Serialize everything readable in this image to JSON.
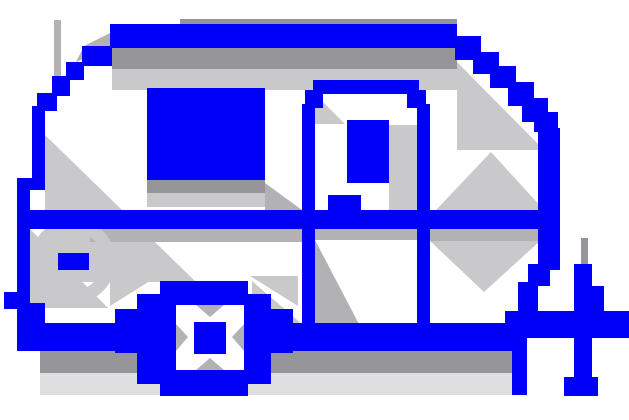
{
  "canvas": {
    "width": 629,
    "height": 420,
    "background": "#ffffff"
  },
  "icon": {
    "name": "camper-trailer-pixel-icon",
    "palette": {
      "blue": "#0000f8",
      "white": "#ffffff",
      "grayDark": "#96969a",
      "grayMid": "#b2b2b4",
      "grayLight": "#c9c9cb",
      "grayPale": "#dfdfe1"
    },
    "shapes": [
      {
        "name": "shadow-roof-topline",
        "type": "rect",
        "x": 180,
        "y": 19,
        "w": 277,
        "h": 6,
        "fill": "grayDark"
      },
      {
        "name": "shadow-under-roof-dark",
        "type": "rect",
        "x": 112,
        "y": 48,
        "w": 345,
        "h": 21,
        "fill": "grayDark"
      },
      {
        "name": "shadow-under-roof-light",
        "type": "rect",
        "x": 112,
        "y": 69,
        "w": 345,
        "h": 21,
        "fill": "grayLight"
      },
      {
        "name": "shadow-front-line",
        "type": "rect",
        "x": 54,
        "y": 20,
        "w": 7,
        "h": 74,
        "fill": "grayMid"
      },
      {
        "name": "shadow-front-wedge",
        "type": "polygon",
        "points": [
          [
            110,
            33
          ],
          [
            110,
            48
          ],
          [
            76,
            62
          ],
          [
            84,
            46
          ]
        ],
        "fill": "grayMid"
      },
      {
        "name": "shadow-left-interior",
        "type": "polygon",
        "points": [
          [
            45,
            135
          ],
          [
            196,
            282
          ],
          [
            45,
            282
          ]
        ],
        "fill": "grayLight"
      },
      {
        "name": "shadow-right-interior",
        "type": "polygon",
        "points": [
          [
            457,
            62
          ],
          [
            544,
            150
          ],
          [
            457,
            150
          ]
        ],
        "fill": "grayLight"
      },
      {
        "name": "shadow-window-sill-dark",
        "type": "rect",
        "x": 147,
        "y": 180,
        "w": 118,
        "h": 13,
        "fill": "grayDark"
      },
      {
        "name": "shadow-window-sill-light",
        "type": "rect",
        "x": 147,
        "y": 193,
        "w": 118,
        "h": 14,
        "fill": "grayLight"
      },
      {
        "name": "shadow-window-door-wedge",
        "type": "polygon",
        "points": [
          [
            265,
            183
          ],
          [
            302,
            210
          ],
          [
            265,
            210
          ]
        ],
        "fill": "grayMid"
      },
      {
        "name": "shadow-door-jamb",
        "type": "rect",
        "x": 389,
        "y": 125,
        "w": 28,
        "h": 104,
        "fill": "grayLight"
      },
      {
        "name": "shadow-door-top-wedge",
        "type": "polygon",
        "points": [
          [
            315,
            94
          ],
          [
            345,
            124
          ],
          [
            315,
            124
          ]
        ],
        "fill": "grayLight"
      },
      {
        "name": "shadow-under-rail-left",
        "type": "rect",
        "x": 90,
        "y": 229,
        "w": 212,
        "h": 13,
        "fill": "grayMid"
      },
      {
        "name": "shadow-under-rail-right",
        "type": "rect",
        "x": 430,
        "y": 229,
        "w": 108,
        "h": 12,
        "fill": "grayMid"
      },
      {
        "name": "shadow-under-rail-door",
        "type": "rect",
        "x": 315,
        "y": 229,
        "w": 102,
        "h": 11,
        "fill": "grayMid"
      },
      {
        "name": "shadow-door-lower-wedge",
        "type": "polygon",
        "points": [
          [
            315,
            240
          ],
          [
            360,
            326
          ],
          [
            315,
            326
          ]
        ],
        "fill": "grayMid"
      },
      {
        "name": "shadow-rail-x-upper",
        "type": "polygon",
        "points": [
          [
            436,
            210
          ],
          [
            544,
            210
          ],
          [
            491,
            152
          ]
        ],
        "fill": "grayLight"
      },
      {
        "name": "shadow-rail-x-lower",
        "type": "polygon",
        "points": [
          [
            430,
            241
          ],
          [
            540,
            241
          ],
          [
            484,
            292
          ]
        ],
        "fill": "grayLight"
      },
      {
        "name": "shadow-left-under-rail",
        "type": "polygon",
        "points": [
          [
            30,
            229
          ],
          [
            108,
            308
          ],
          [
            30,
            308
          ]
        ],
        "fill": "grayLight"
      },
      {
        "name": "shadow-wheel-door-wedge",
        "type": "polygon",
        "points": [
          [
            252,
            281
          ],
          [
            302,
            324
          ],
          [
            252,
            324
          ]
        ],
        "fill": "grayLight"
      },
      {
        "name": "shadow-badge-ring",
        "type": "circle",
        "cx": 73,
        "cy": 261,
        "r": 36,
        "stroke": "grayLight",
        "strokeWidth": 13
      },
      {
        "name": "shadow-wheel-corner-tl",
        "type": "polygon",
        "points": [
          [
            110,
            306
          ],
          [
            158,
            276
          ],
          [
            110,
            276
          ]
        ],
        "fill": "grayLight"
      },
      {
        "name": "shadow-wheel-corner-tr",
        "type": "polygon",
        "points": [
          [
            298,
            306
          ],
          [
            250,
            276
          ],
          [
            298,
            276
          ]
        ],
        "fill": "grayLight"
      },
      {
        "name": "shadow-wheel-corner-bl",
        "type": "polygon",
        "points": [
          [
            110,
            356
          ],
          [
            158,
            390
          ],
          [
            110,
            390
          ]
        ],
        "fill": "grayLight"
      },
      {
        "name": "shadow-wheel-corner-br",
        "type": "polygon",
        "points": [
          [
            298,
            356
          ],
          [
            250,
            390
          ],
          [
            298,
            390
          ]
        ],
        "fill": "grayLight"
      },
      {
        "name": "shadow-under-chassis-dark",
        "type": "rect",
        "x": 40,
        "y": 351,
        "w": 478,
        "h": 22,
        "fill": "grayDark"
      },
      {
        "name": "shadow-under-chassis-light",
        "type": "rect",
        "x": 40,
        "y": 373,
        "w": 478,
        "h": 22,
        "fill": "grayPale"
      },
      {
        "name": "shadow-jack-line",
        "type": "rect",
        "x": 581,
        "y": 238,
        "w": 7,
        "h": 28,
        "fill": "grayDark"
      },
      {
        "name": "roof-bar",
        "type": "rect",
        "x": 110,
        "y": 24,
        "w": 347,
        "h": 24,
        "fill": "blue"
      },
      {
        "name": "roof-step-left-1",
        "type": "rect",
        "x": 82,
        "y": 46,
        "w": 30,
        "h": 20,
        "fill": "blue"
      },
      {
        "name": "roof-step-left-2",
        "type": "rect",
        "x": 66,
        "y": 62,
        "w": 18,
        "h": 18,
        "fill": "blue"
      },
      {
        "name": "roof-step-left-3",
        "type": "rect",
        "x": 52,
        "y": 76,
        "w": 18,
        "h": 20,
        "fill": "blue"
      },
      {
        "name": "roof-step-left-4",
        "type": "rect",
        "x": 37,
        "y": 93,
        "w": 20,
        "h": 18,
        "fill": "blue"
      },
      {
        "name": "body-left-edge-upper",
        "type": "rect",
        "x": 32,
        "y": 106,
        "w": 13,
        "h": 82,
        "fill": "blue"
      },
      {
        "name": "body-left-jog",
        "type": "rect",
        "x": 17,
        "y": 178,
        "w": 28,
        "h": 12,
        "fill": "blue"
      },
      {
        "name": "body-left-edge-lower",
        "type": "rect",
        "x": 17,
        "y": 184,
        "w": 13,
        "h": 126,
        "fill": "blue"
      },
      {
        "name": "body-left-bump",
        "type": "rect",
        "x": 4,
        "y": 292,
        "w": 14,
        "h": 17,
        "fill": "blue"
      },
      {
        "name": "body-left-foot",
        "type": "rect",
        "x": 17,
        "y": 303,
        "w": 28,
        "h": 22,
        "fill": "blue"
      },
      {
        "name": "chassis-bar",
        "type": "rect",
        "x": 17,
        "y": 323,
        "w": 501,
        "h": 28,
        "fill": "blue"
      },
      {
        "name": "belt-rail",
        "type": "rect",
        "x": 28,
        "y": 210,
        "w": 532,
        "h": 19,
        "fill": "blue"
      },
      {
        "name": "window-main",
        "type": "rect",
        "x": 147,
        "y": 88,
        "w": 118,
        "h": 92,
        "fill": "blue"
      },
      {
        "name": "door-top",
        "type": "rect",
        "x": 313,
        "y": 80,
        "w": 106,
        "h": 14,
        "fill": "blue"
      },
      {
        "name": "door-corner-left",
        "type": "rect",
        "x": 305,
        "y": 90,
        "w": 18,
        "h": 18,
        "fill": "blue"
      },
      {
        "name": "door-corner-right",
        "type": "rect",
        "x": 407,
        "y": 90,
        "w": 19,
        "h": 18,
        "fill": "blue"
      },
      {
        "name": "door-frame-left",
        "type": "rect",
        "x": 302,
        "y": 104,
        "w": 13,
        "h": 222,
        "fill": "blue"
      },
      {
        "name": "door-frame-right",
        "type": "rect",
        "x": 417,
        "y": 104,
        "w": 13,
        "h": 222,
        "fill": "blue"
      },
      {
        "name": "door-window",
        "type": "rect",
        "x": 347,
        "y": 120,
        "w": 42,
        "h": 63,
        "fill": "blue"
      },
      {
        "name": "door-handle",
        "type": "rect",
        "x": 328,
        "y": 195,
        "w": 33,
        "h": 16,
        "fill": "blue"
      },
      {
        "name": "side-badge",
        "type": "rect",
        "x": 58,
        "y": 253,
        "w": 31,
        "h": 17,
        "fill": "blue"
      },
      {
        "name": "roof-step-right-1",
        "type": "rect",
        "x": 455,
        "y": 36,
        "w": 26,
        "h": 24,
        "fill": "blue"
      },
      {
        "name": "roof-step-right-2",
        "type": "rect",
        "x": 473,
        "y": 52,
        "w": 26,
        "h": 22,
        "fill": "blue"
      },
      {
        "name": "roof-step-right-3",
        "type": "rect",
        "x": 490,
        "y": 66,
        "w": 26,
        "h": 22,
        "fill": "blue"
      },
      {
        "name": "roof-step-right-4",
        "type": "rect",
        "x": 508,
        "y": 82,
        "w": 26,
        "h": 24,
        "fill": "blue"
      },
      {
        "name": "roof-step-right-5",
        "type": "rect",
        "x": 522,
        "y": 98,
        "w": 26,
        "h": 24,
        "fill": "blue"
      },
      {
        "name": "roof-step-right-6",
        "type": "rect",
        "x": 534,
        "y": 112,
        "w": 24,
        "h": 20,
        "fill": "blue"
      },
      {
        "name": "body-right-edge",
        "type": "rect",
        "x": 538,
        "y": 128,
        "w": 22,
        "h": 142,
        "fill": "blue"
      },
      {
        "name": "body-right-step-1",
        "type": "rect",
        "x": 528,
        "y": 264,
        "w": 22,
        "h": 22,
        "fill": "blue"
      },
      {
        "name": "body-right-step-2",
        "type": "rect",
        "x": 518,
        "y": 282,
        "w": 20,
        "h": 30,
        "fill": "blue"
      },
      {
        "name": "hitch-bar",
        "type": "rect",
        "x": 505,
        "y": 311,
        "w": 124,
        "h": 27,
        "fill": "blue"
      },
      {
        "name": "rear-support-leg",
        "type": "rect",
        "x": 512,
        "y": 338,
        "w": 15,
        "h": 57,
        "fill": "blue"
      },
      {
        "name": "wheel-center-column",
        "type": "rect",
        "x": 160,
        "y": 281,
        "w": 88,
        "h": 115,
        "fill": "blue"
      },
      {
        "name": "wheel-middle",
        "type": "rect",
        "x": 137,
        "y": 294,
        "w": 134,
        "h": 90,
        "fill": "blue"
      },
      {
        "name": "wheel-widest",
        "type": "rect",
        "x": 115,
        "y": 309,
        "w": 178,
        "h": 44,
        "fill": "blue"
      },
      {
        "name": "jack-post-upper",
        "type": "rect",
        "x": 574,
        "y": 264,
        "w": 18,
        "h": 48,
        "fill": "blue"
      },
      {
        "name": "jack-crank",
        "type": "rect",
        "x": 590,
        "y": 286,
        "w": 14,
        "h": 27,
        "fill": "blue"
      },
      {
        "name": "jack-post-lower",
        "type": "rect",
        "x": 574,
        "y": 338,
        "w": 18,
        "h": 42,
        "fill": "blue"
      },
      {
        "name": "jack-foot",
        "type": "rect",
        "x": 564,
        "y": 377,
        "w": 34,
        "h": 19,
        "fill": "blue"
      },
      {
        "name": "wheel-hub-ring",
        "type": "rect",
        "x": 176,
        "y": 305,
        "w": 68,
        "h": 65,
        "fill": "white"
      },
      {
        "name": "hub-bevel-top",
        "type": "polygon",
        "points": [
          [
            196,
            305
          ],
          [
            224,
            305
          ],
          [
            210,
            317
          ]
        ],
        "fill": "grayMid"
      },
      {
        "name": "hub-bevel-bottom",
        "type": "polygon",
        "points": [
          [
            196,
            370
          ],
          [
            224,
            370
          ],
          [
            210,
            358
          ]
        ],
        "fill": "grayMid"
      },
      {
        "name": "hub-bevel-left",
        "type": "polygon",
        "points": [
          [
            176,
            324
          ],
          [
            176,
            351
          ],
          [
            188,
            337
          ]
        ],
        "fill": "grayMid"
      },
      {
        "name": "hub-bevel-right",
        "type": "polygon",
        "points": [
          [
            244,
            324
          ],
          [
            244,
            351
          ],
          [
            232,
            337
          ]
        ],
        "fill": "grayMid"
      },
      {
        "name": "wheel-hub-center",
        "type": "rect",
        "x": 194,
        "y": 322,
        "w": 32,
        "h": 32,
        "fill": "blue"
      }
    ]
  }
}
